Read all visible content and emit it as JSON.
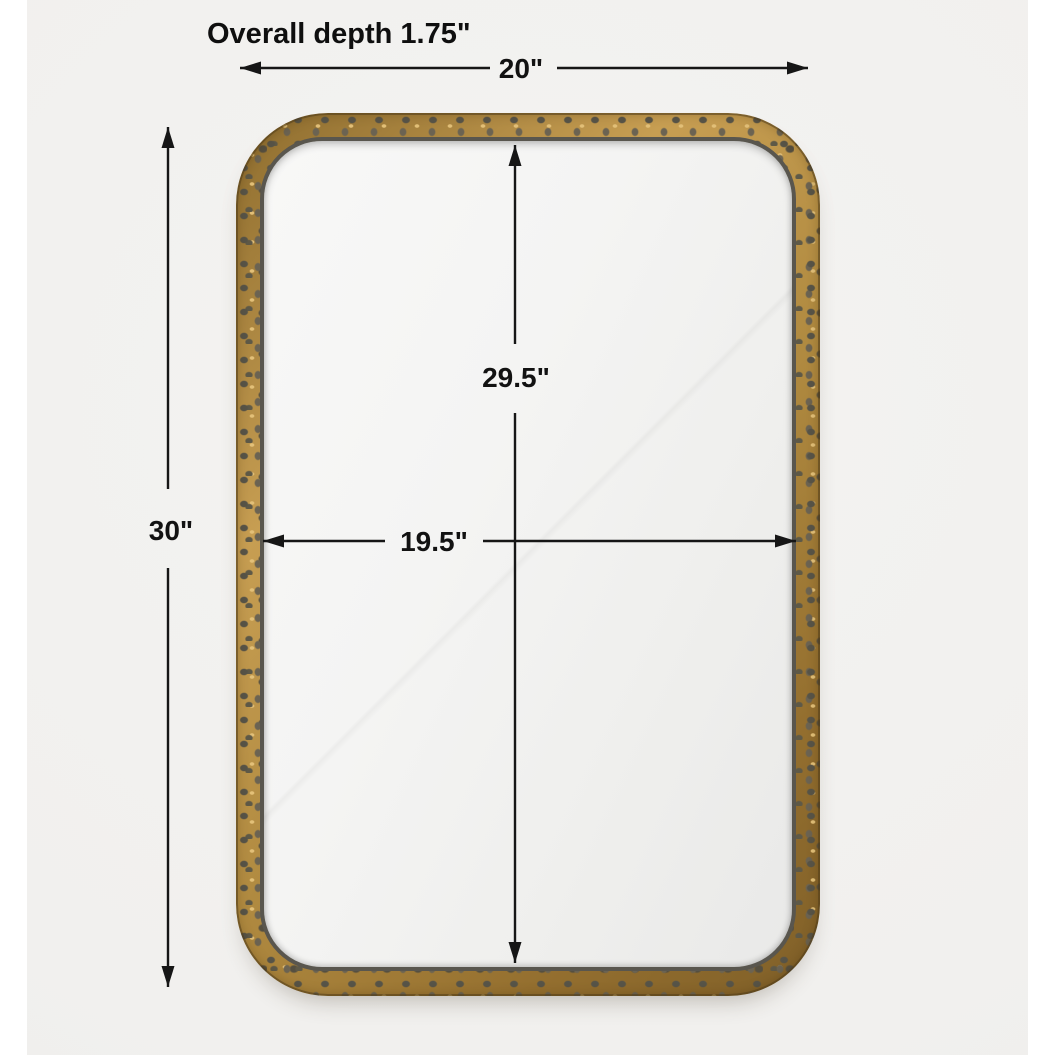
{
  "annotations": {
    "depth_label": "Overall depth 1.75\"",
    "width_label": "20\"",
    "height_label": "30\"",
    "inner_height_label": "29.5\"",
    "inner_width_label": "19.5\""
  },
  "dimensions": {
    "overall_depth_in": 1.75,
    "overall_width_in": 20,
    "overall_height_in": 30,
    "inner_height_in": 29.5,
    "inner_width_in": 19.5
  },
  "colors": {
    "photo_background": "#f1f0ee",
    "page_background": "#ffffff",
    "frame_gold": "#b08a40",
    "frame_dimple": "#5e5947",
    "frame_inner_lip": "#59564e",
    "glass": "#f0f0ef",
    "annotation": "#121212"
  }
}
